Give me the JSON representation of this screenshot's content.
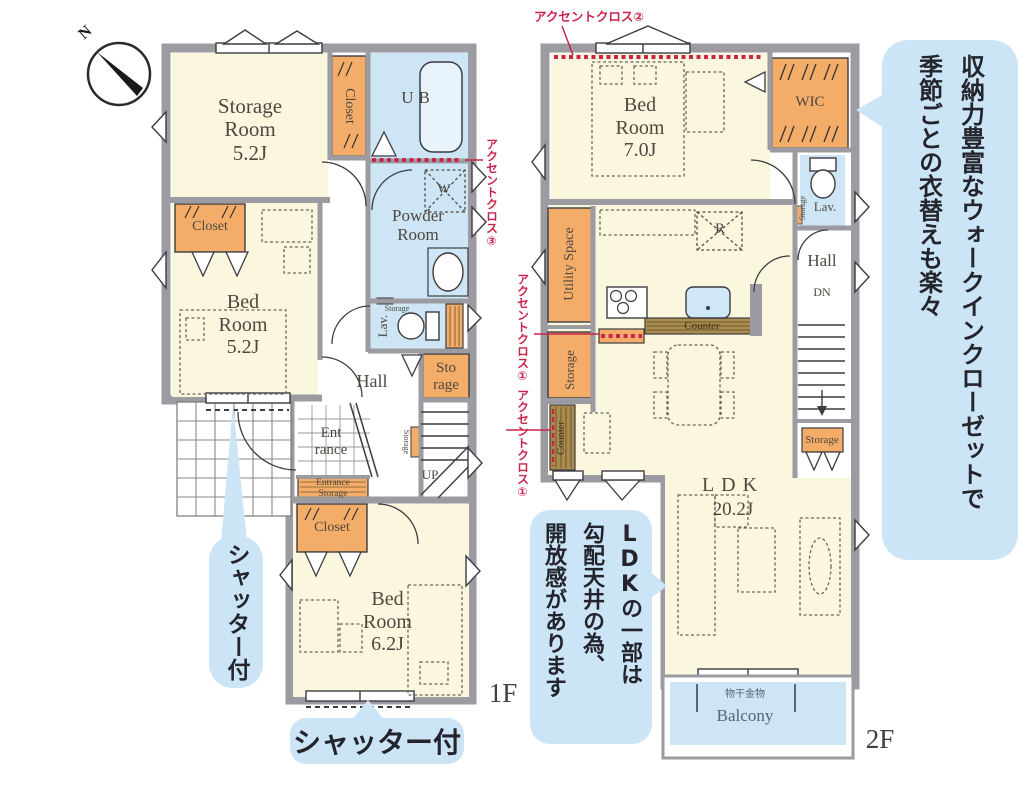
{
  "colors": {
    "wall": "#9B9BA1",
    "room_cream": "#FBF6DE",
    "fixture_blue": "#CDE5F4",
    "storage_orange": "#F4AD69",
    "counter_brown": "#A98C4F",
    "accent_red": "#C9254B",
    "note_bubble_blue": "#CBE5F7",
    "label_text": "#4D4840"
  },
  "compass": {
    "north": "N"
  },
  "floor1": {
    "label": "1F",
    "rooms": {
      "storage_room": "Storage\nRoom\n5.2J",
      "closet_top": "Closet",
      "bath": "UB",
      "powder_room": "Powder\nRoom",
      "washer": "W",
      "closet_mid": "Closet",
      "bed_room": "Bed\nRoom\n5.2J",
      "hall": "Hall",
      "lavatory": "Lav.",
      "lav_storage": "Storage",
      "storage": "Sto\nrage",
      "entrance": "Ent\nrance",
      "entrance_storage": "Entrance\nStorage",
      "stair_storage": "Storage",
      "up": "UP",
      "closet_bottom": "Closet",
      "bed_room2": "Bed\nRoom\n6.2J"
    }
  },
  "floor2": {
    "label": "2F",
    "rooms": {
      "bed_room": "Bed\nRoom\n7.0J",
      "wic": "WIC",
      "lavatory": "Lav.",
      "lav_storage": "Storage",
      "hall": "Hall",
      "down": "DN",
      "hall_storage": "Storage",
      "utility_space": "Utility Space",
      "fridge": "R",
      "kitchen_counter": "Counter",
      "storage_left": "Storage",
      "side_counter": "Counter",
      "ldk_name": "LDK",
      "ldk_size": "20.2J",
      "laundry_fitting": "物干金物",
      "balcony": "Balcony"
    }
  },
  "annotations": {
    "accent_cross_top": "アクセントクロス②",
    "accent_cross_powder": "アクセントクロス③",
    "accent_cross_kitchen": "アクセントクロス①",
    "accent_cross_counter": "アクセントクロス①",
    "shutter_left": "シャッター付",
    "shutter_bottom": "シャッター付",
    "wic_note": [
      "収納力豊富なウォークインクローゼットで",
      "季節ごとの衣替えも楽々"
    ],
    "ldk_note": [
      "LDKの一部は",
      "勾配天井の為、",
      "開放感があります"
    ]
  }
}
